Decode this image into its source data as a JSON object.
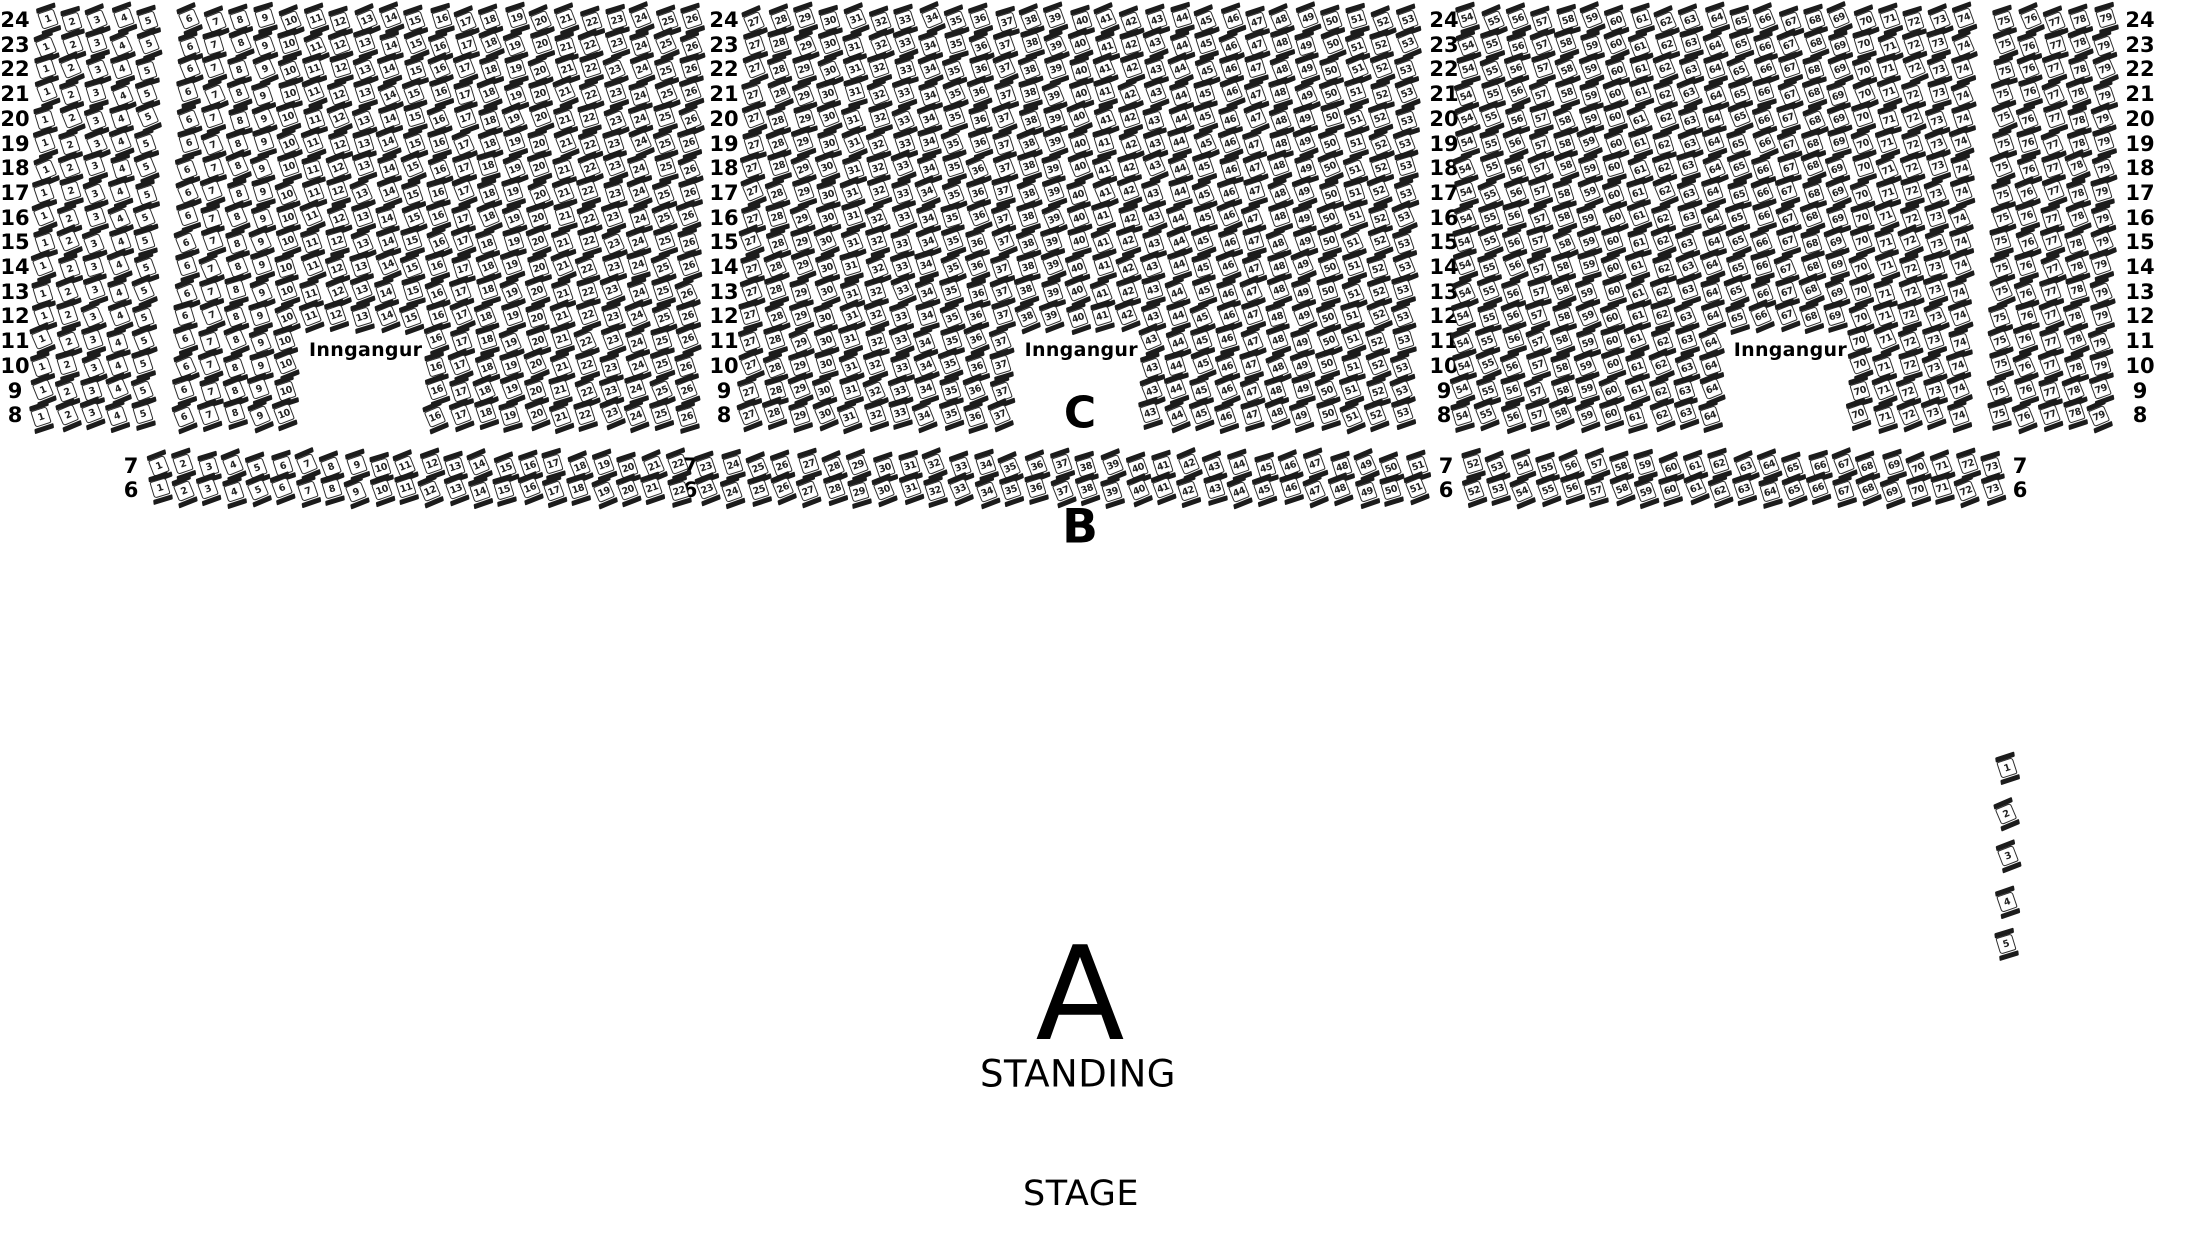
{
  "map": {
    "width": 2190,
    "height": 1260
  },
  "seating": {
    "upper_section": {
      "section_label": "C",
      "rows": [
        24,
        23,
        22,
        21,
        20,
        19,
        18,
        17,
        16,
        15,
        14,
        13,
        12,
        11,
        10,
        9,
        8
      ],
      "entrance_rows": [
        11,
        10,
        9,
        8
      ],
      "blocks": [
        {
          "seats_from": 1,
          "seats_to": 5
        },
        {
          "seats_from": 6,
          "seats_to": 26,
          "entrance_gap_from": 11,
          "entrance_gap_to": 15,
          "entrance_label": "Inngangur"
        },
        {
          "seats_from": 27,
          "seats_to": 53,
          "entrance_gap_from": 38,
          "entrance_gap_to": 42,
          "entrance_label": "Inngangur"
        },
        {
          "seats_from": 54,
          "seats_to": 74,
          "entrance_gap_from": 65,
          "entrance_gap_to": 69,
          "entrance_label": "Inngangur"
        },
        {
          "seats_from": 75,
          "seats_to": 79
        }
      ]
    },
    "row_b_section": {
      "section_label": "B",
      "rows": [
        7,
        6
      ],
      "segments": [
        {
          "seats_from": 1,
          "seats_to": 22
        },
        {
          "seats_from": 23,
          "seats_to": 51
        },
        {
          "seats_from": 52,
          "seats_to": 73
        }
      ]
    },
    "standing_section": {
      "section_label": "A",
      "label": "STANDING"
    },
    "stage": {
      "label": "STAGE"
    },
    "side_seats": [
      1,
      2,
      3,
      4,
      5
    ]
  },
  "geometry": {
    "seat_color": "#ffffff",
    "line_color": "#1c1c1c",
    "upper": {
      "y_top": 20,
      "row_dy": 24.7,
      "row_x_drift": 0.35,
      "label_cols_x": [
        15,
        724,
        1444,
        2140
      ],
      "blocks_x0": [
        47,
        190,
        755,
        1468,
        2005
      ],
      "blocks_dx": [
        25.3,
        25.1,
        25.1,
        24.8,
        25.1
      ],
      "entrance_y": 350
    },
    "row_b": {
      "ys": [
        466,
        490
      ],
      "labels_x": [
        131,
        690,
        1446,
        2020
      ],
      "segs_x0": [
        159,
        707,
        1473
      ],
      "segs_dx": [
        24.7,
        25.35,
        24.7
      ]
    },
    "side": {
      "x": 2007,
      "y0": 770,
      "dy": 43.5
    }
  }
}
